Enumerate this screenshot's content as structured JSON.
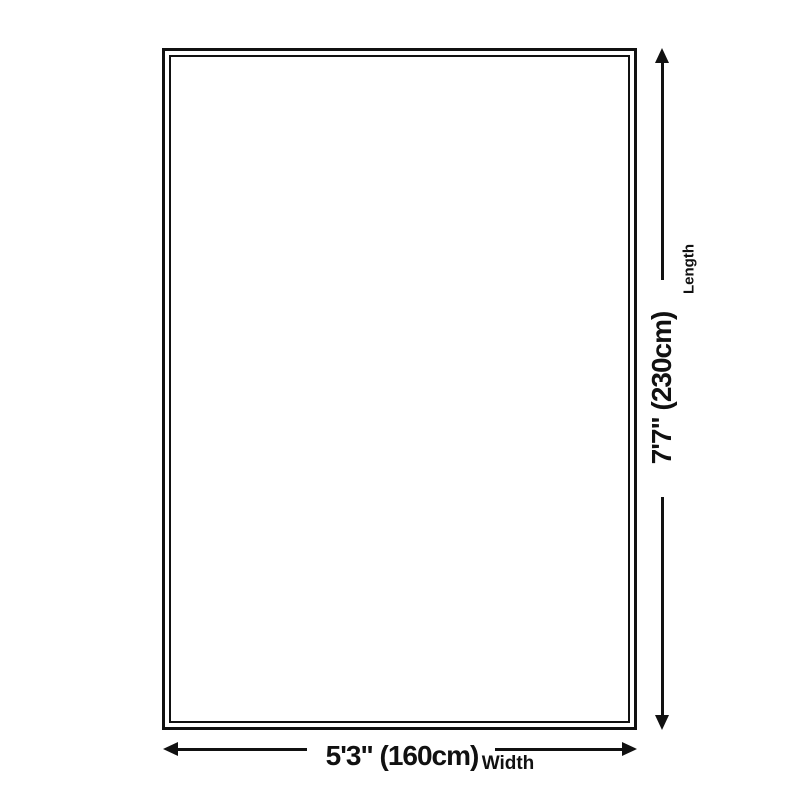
{
  "diagram": {
    "width": {
      "value": "5'3\" (160cm)",
      "label": "Width"
    },
    "length": {
      "value": "7'7\" (230cm)",
      "label": "Length"
    },
    "colors": {
      "line": "#111111",
      "background": "#ffffff"
    },
    "icons": {
      "length_arrow": "double-headed-vertical-arrow",
      "width_arrow": "double-headed-horizontal-arrow"
    }
  }
}
